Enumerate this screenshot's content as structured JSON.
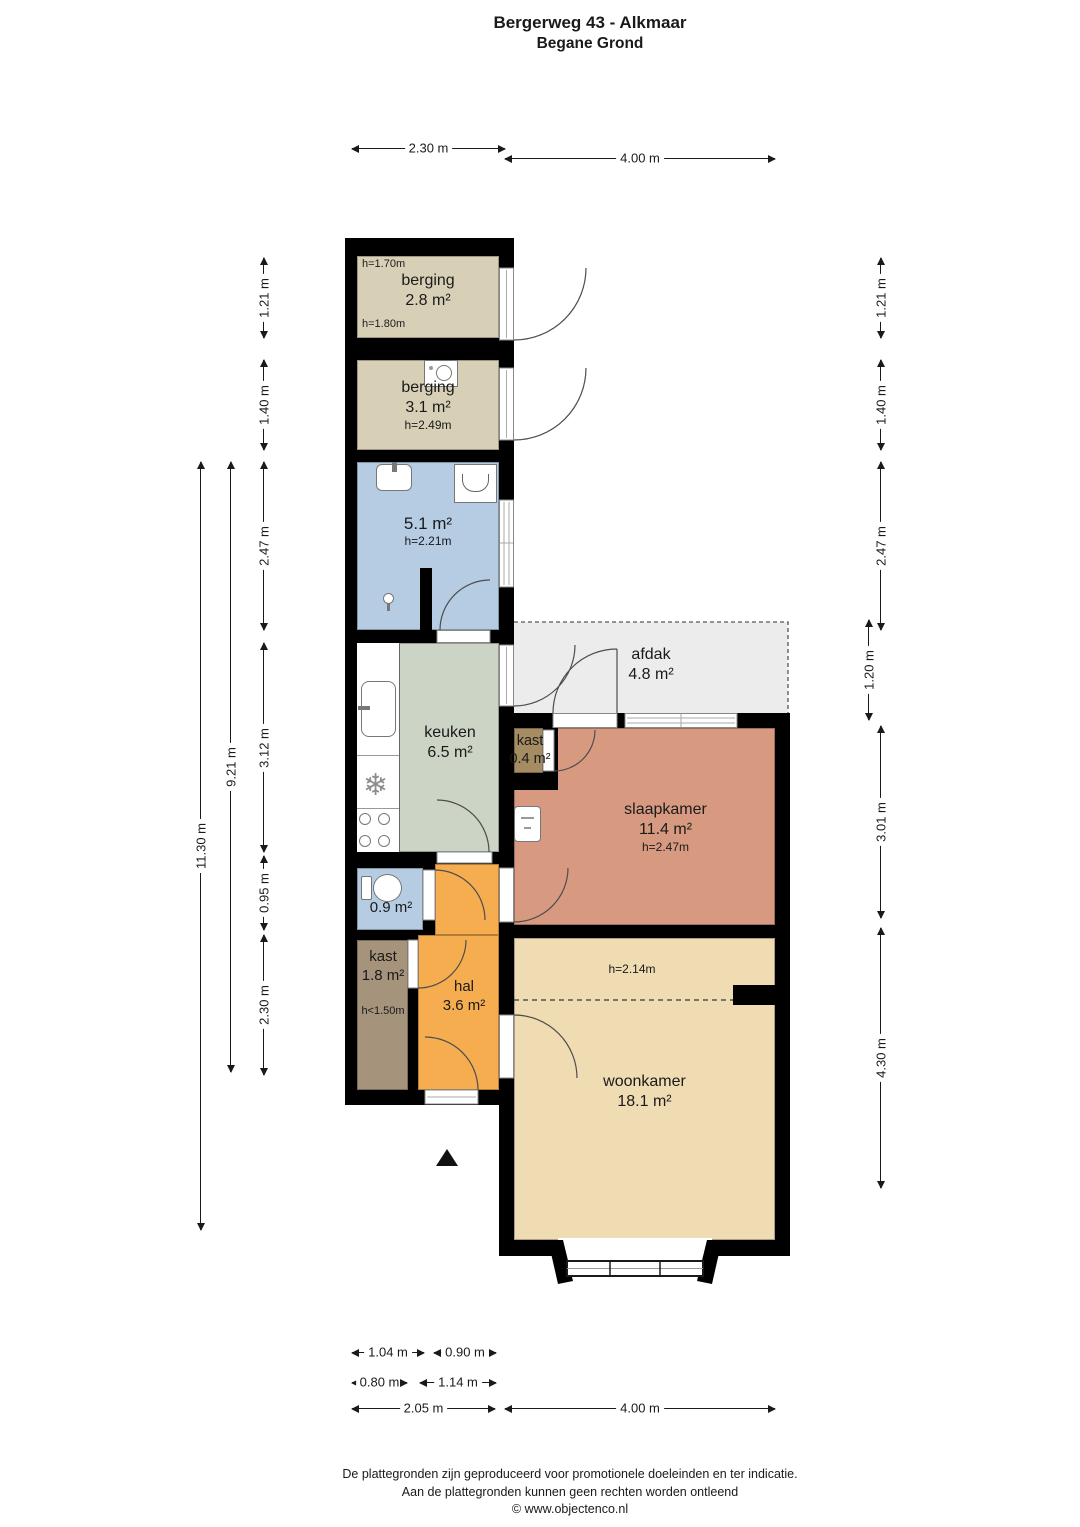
{
  "title": {
    "line1": "Bergerweg 43 - Alkmaar",
    "line2": "Begane Grond"
  },
  "rooms": {
    "berging_1": {
      "name": "berging",
      "area": "2.8 m²",
      "height_top": "h=1.70m",
      "height_bottom": "h=1.80m"
    },
    "berging_2": {
      "name": "berging",
      "area": "3.1 m²",
      "height": "h=2.49m"
    },
    "badkamer": {
      "area": "5.1 m²",
      "height": "h=2.21m"
    },
    "keuken": {
      "name": "keuken",
      "area": "6.5 m²"
    },
    "afdak": {
      "name": "afdak",
      "area": "4.8 m²"
    },
    "kast_slaapkamer": {
      "name": "kast",
      "area": "0.4 m²"
    },
    "slaapkamer": {
      "name": "slaapkamer",
      "area": "11.4 m²",
      "height": "h=2.47m"
    },
    "toilet": {
      "area": "0.9 m²"
    },
    "kast_hal": {
      "name": "kast",
      "area": "1.8 m²",
      "height": "h<1.50m"
    },
    "hal": {
      "name": "hal",
      "area": "3.6 m²"
    },
    "woonkamer": {
      "name": "woonkamer",
      "area": "18.1 m²",
      "height": "h=2.14m"
    }
  },
  "dimensions": {
    "top": [
      "2.30 m",
      "4.00 m"
    ],
    "left_segments": [
      "1.21 m",
      "1.40 m",
      "2.47 m",
      "3.12 m",
      "0.95 m",
      "2.30 m"
    ],
    "left_totals": [
      "9.21 m",
      "11.30 m"
    ],
    "right_segments": [
      "1.21 m",
      "1.40 m",
      "2.47 m",
      "1.20 m",
      "3.01 m",
      "4.30 m"
    ],
    "bottom_row_1": [
      "1.04 m",
      "0.90 m"
    ],
    "bottom_row_2": [
      "0.80 m",
      "1.14 m"
    ],
    "bottom_row_3": [
      "2.05 m",
      "4.00 m"
    ]
  },
  "colors": {
    "wall": "#000000",
    "berging": "#d8d0b6",
    "badkamer": "#b5cce3",
    "keuken": "#ccd4c6",
    "kast_slaapkamer": "#a58c62",
    "slaapkamer": "#d79a81",
    "toilet": "#b5cce3",
    "kast_hal": "#a5937b",
    "hal": "#f5ad50",
    "woonkamer": "#f0dcb2",
    "afdak": "#ececec"
  },
  "icons": [
    "washing-machine-icon",
    "bath-sink-icon",
    "shower-tray-icon",
    "shower-icon",
    "kitchen-sink-icon",
    "fridge-icon",
    "stove-icon",
    "toilet-icon",
    "boiler-icon",
    "north-arrow-icon"
  ],
  "footer": {
    "line1": "De plattegronden zijn geproduceerd voor promotionele doeleinden en ter indicatie.",
    "line2": "Aan de plattegronden kunnen geen rechten worden ontleend",
    "line3": "© www.objectenco.nl"
  }
}
